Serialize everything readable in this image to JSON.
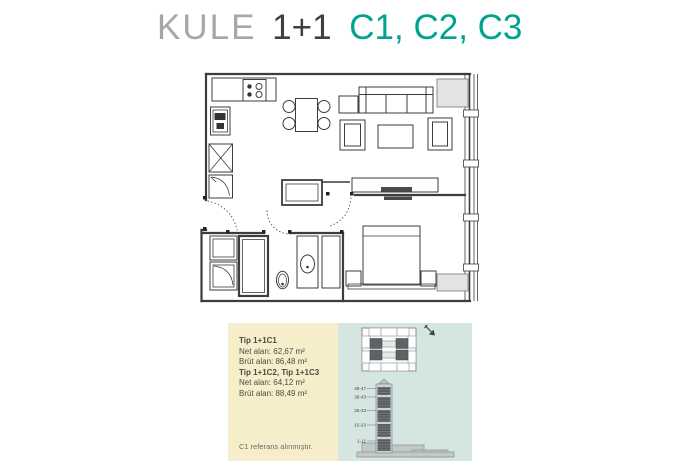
{
  "title": {
    "brand": "KULE",
    "unit_type": "1+1",
    "variants": "C1, C2, C3"
  },
  "info_box": {
    "specs": [
      {
        "label": "Tip 1+1C1",
        "lines": [
          "Net alan: 62,67 m²",
          "Brüt alan: 86,48 m²"
        ]
      },
      {
        "label": "Tip 1+1C2, Tip 1+1C3",
        "lines": [
          "Net alan: 64,12 m²",
          "Brüt alan: 88,49 m²"
        ]
      }
    ],
    "footnote": "C1 referans alınmıştır.",
    "tower": {
      "floor_labels": [
        "45-47",
        "39-43",
        "25-33",
        "15-23",
        "1-11"
      ]
    }
  },
  "icons": {
    "direction_arrow": "arrow-down-right"
  },
  "colors": {
    "accent_teal": "#00a38f",
    "title_gray": "#a7a7a6",
    "plan_line": "#3d3d3d",
    "cream_bg": "#f6eeca",
    "blue_bg": "#d5e5e1",
    "highlight_unit": "#5d6266"
  }
}
